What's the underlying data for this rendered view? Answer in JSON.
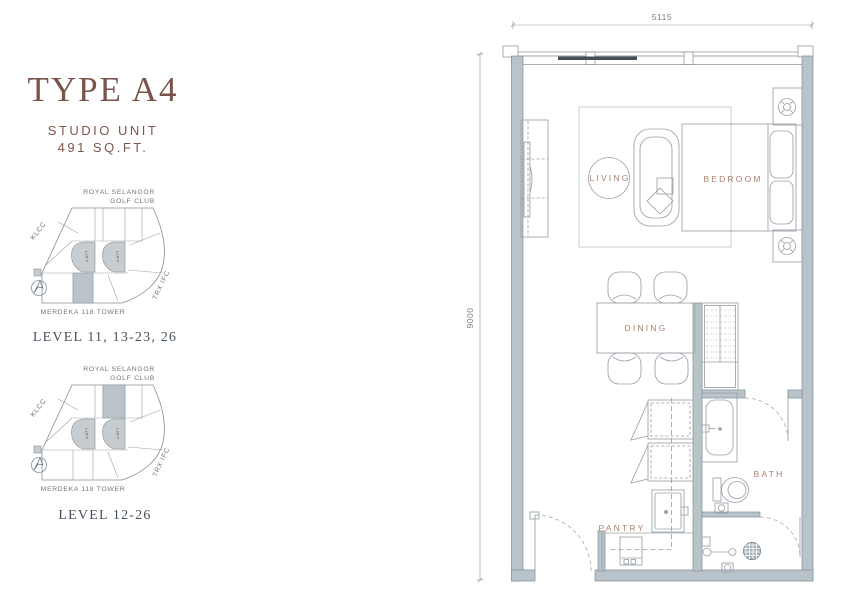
{
  "unit": {
    "type_title": "TYPE A4",
    "category": "STUDIO UNIT",
    "area": "491 SQ.FT."
  },
  "key_plan_labels": {
    "golf_line1": "ROYAL SELANGOR",
    "golf_line2": "GOLF CLUB",
    "klcc": "KLCC",
    "trx": "TRX IFC",
    "merdeka": "MERDEKA 118 TOWER",
    "lift": "LIFT"
  },
  "key_plans": [
    {
      "caption": "LEVEL 11, 13-23, 26"
    },
    {
      "caption": "LEVEL 12-26"
    }
  ],
  "floor_plan": {
    "dim_width": "5115",
    "dim_height": "9000",
    "rooms": {
      "living": "LIVING",
      "bedroom": "BEDROOM",
      "dining": "DINING",
      "pantry": "PANTRY",
      "bath": "BATH"
    }
  },
  "colors": {
    "accent_brown": "#7a544a",
    "room_label_brown": "#a9816e",
    "wall_fill": "#b9c3ca",
    "line_gray": "#9aa2a9",
    "text_gray": "#6e767e"
  }
}
